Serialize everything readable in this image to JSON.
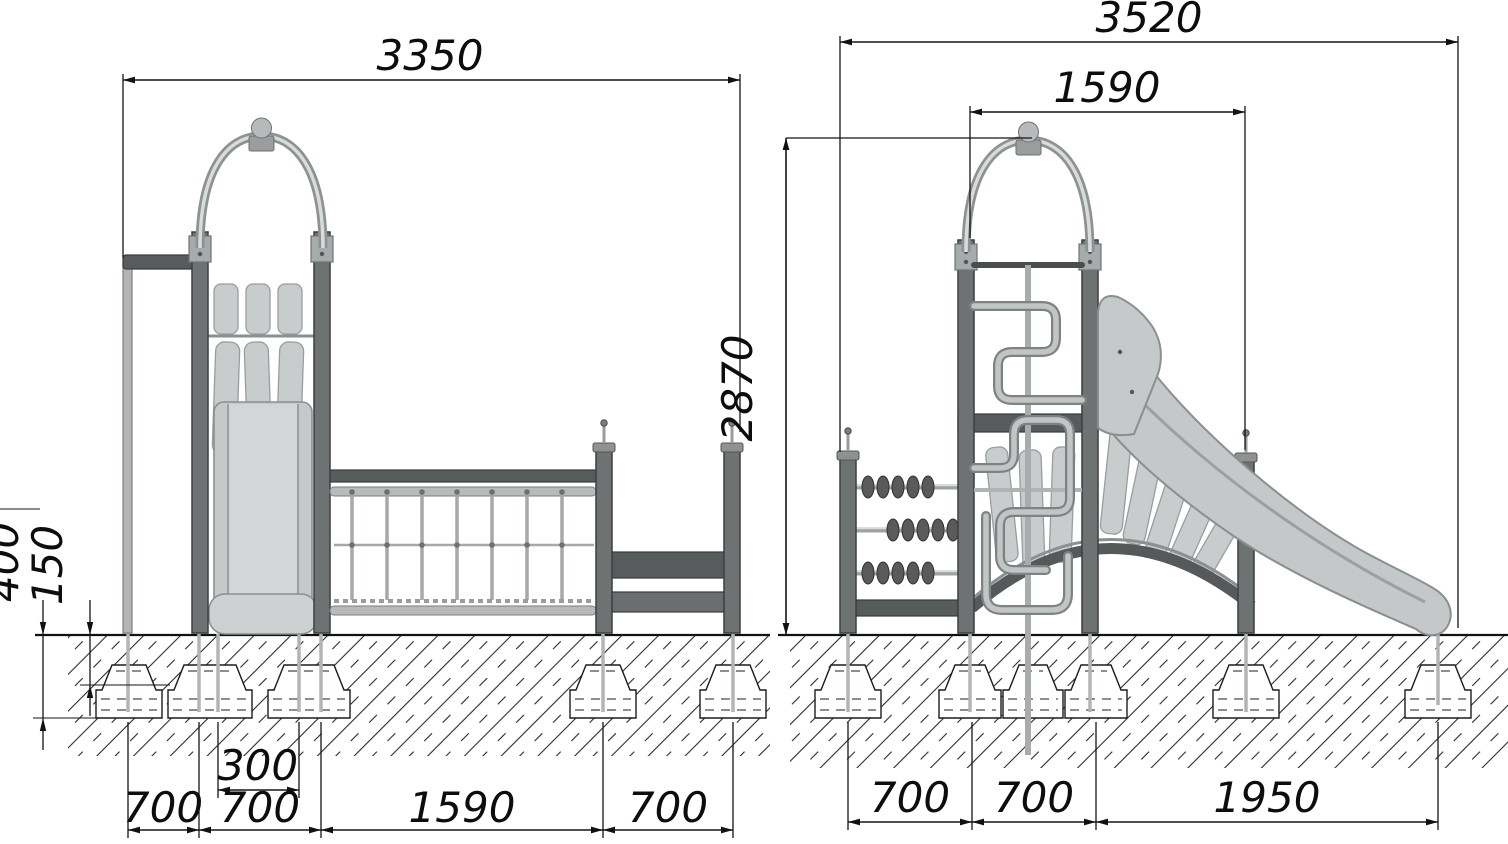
{
  "front_view": {
    "dim_overall_width": "3350",
    "dim_foundation_depth": "400",
    "dim_foundation_top_depth": "150",
    "dim_slide_rail_spacing": "300",
    "dim_span_1": "700",
    "dim_span_2": "700",
    "dim_span_3": "1590",
    "dim_span_4": "700"
  },
  "side_view": {
    "dim_overall_width": "3520",
    "dim_post_spacing": "1590",
    "dim_overall_height": "2870",
    "dim_span_1": "700",
    "dim_span_2": "700",
    "dim_span_3": "1950"
  }
}
